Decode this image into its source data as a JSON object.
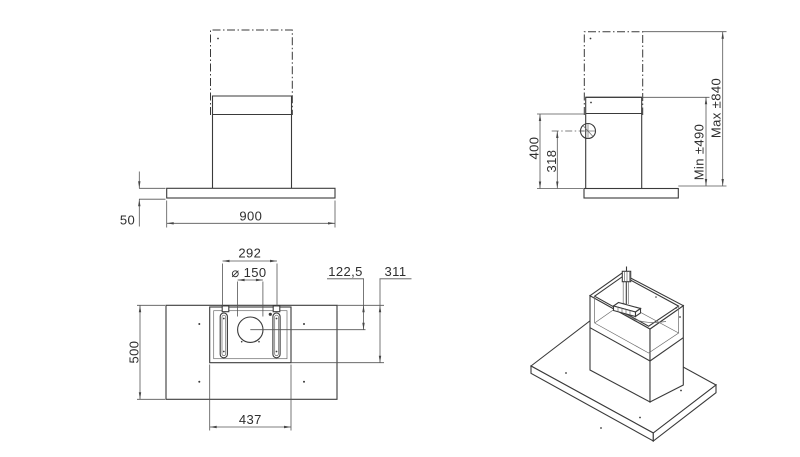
{
  "drawing": {
    "type": "technical-dimension-drawing",
    "subject": "island cooker hood, four orthographic/isometric views",
    "colors": {
      "line": "#3a3a3a",
      "dimension": "#555555",
      "text": "#2e2e2e",
      "background": "#ffffff"
    },
    "views": {
      "front": {
        "canopy_width": "900",
        "canopy_thickness": "50"
      },
      "side": {
        "lower_chimney_height": "400",
        "duct_center_height": "318",
        "min_height": "Min ±490",
        "max_height": "Max ±840"
      },
      "plan": {
        "bracket_spacing": "292",
        "duct_diameter": "⌀ 150",
        "edge_to_duct_center": "122,5",
        "edge_to_box_rear": "311",
        "canopy_depth": "500",
        "mount_box_width": "437"
      }
    }
  }
}
